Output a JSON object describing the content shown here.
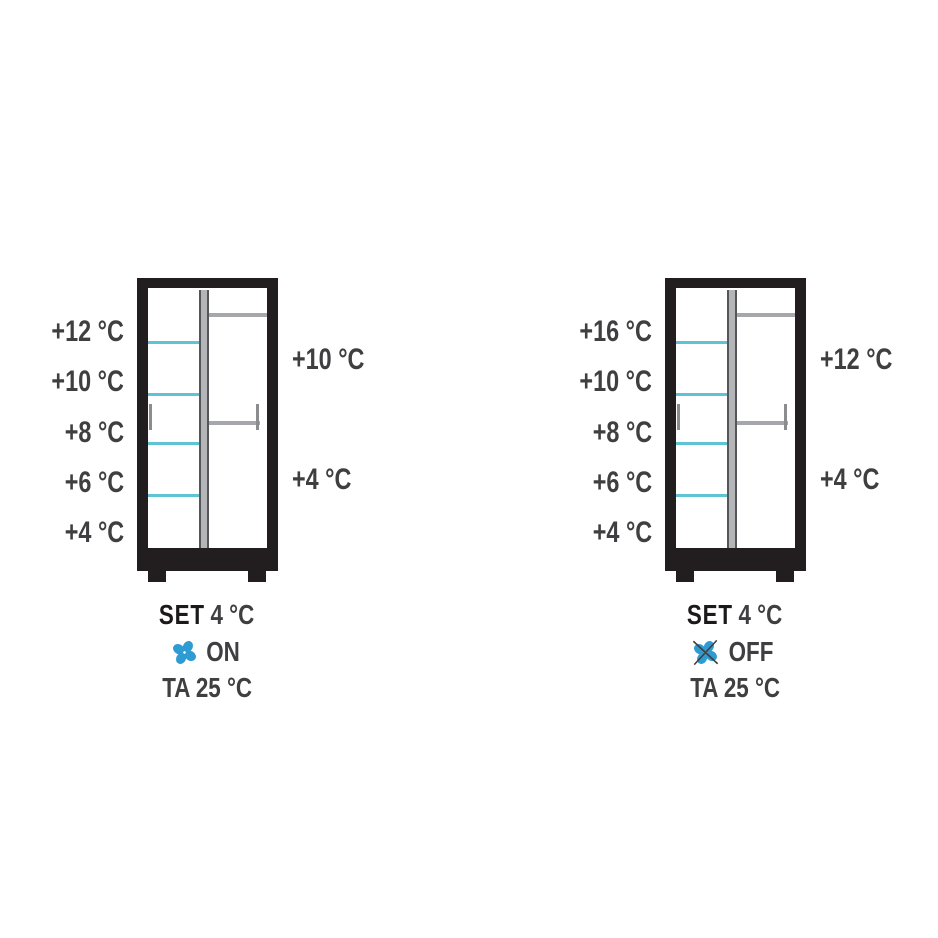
{
  "page": {
    "background": "#ffffff"
  },
  "colors": {
    "page_bg": "#ffffff",
    "frame": "#221e1f",
    "divider_fill": "#b3b5b7",
    "divider_edge": "#55565a",
    "shelf_gray": "#a5a7aa",
    "tick_gray": "#8a8c8f",
    "shelf_cyan": "#5fc3d3",
    "fan_blue": "#2e9bd3",
    "text": "#3f3e40"
  },
  "diagrams": [
    {
      "name": "cabinet-fan-on",
      "left_labels": [
        "+12 °C",
        "+10 °C",
        "+8 °C",
        "+6 °C",
        "+4 °C"
      ],
      "right_labels": [
        "+10 °C",
        "+4 °C"
      ],
      "set_label": "SET",
      "set_value": "4 °C",
      "fan_state": "ON",
      "ambient_label": "TA 25 °C"
    },
    {
      "name": "cabinet-fan-off",
      "left_labels": [
        "+16 °C",
        "+10 °C",
        "+8 °C",
        "+6 °C",
        "+4 °C"
      ],
      "right_labels": [
        "+12 °C",
        "+4 °C"
      ],
      "set_label": "SET",
      "set_value": "4 °C",
      "fan_state": "OFF",
      "ambient_label": "TA 25 °C"
    }
  ]
}
